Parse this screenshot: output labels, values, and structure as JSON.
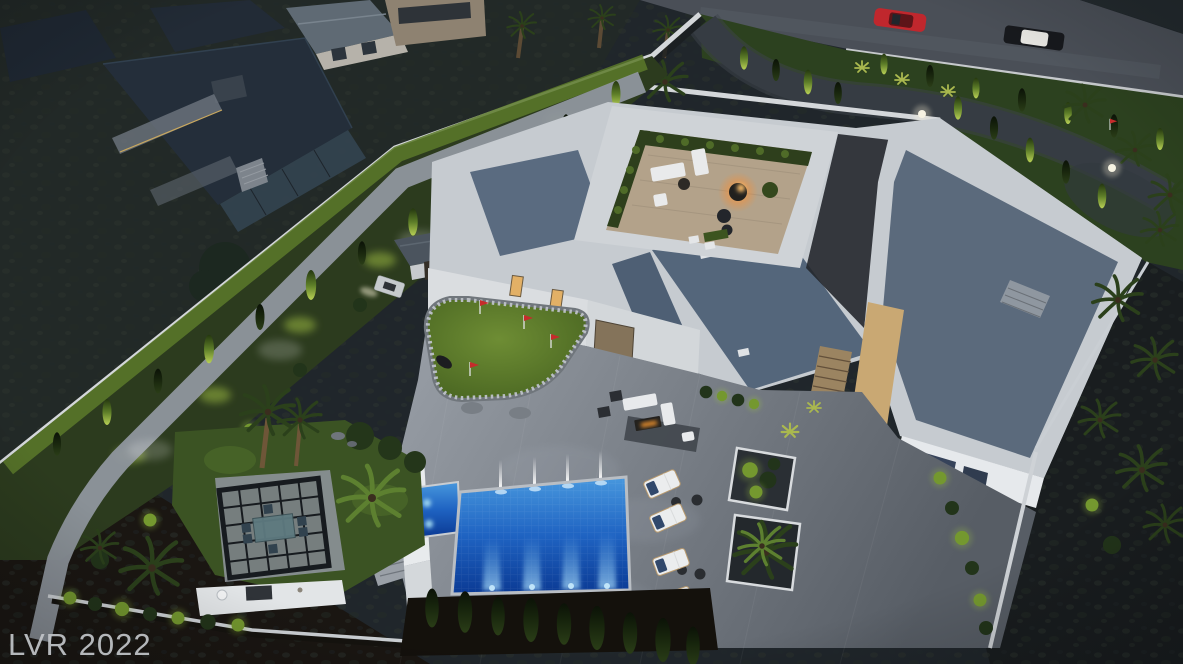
{
  "meta": {
    "description": "Aerial dusk 3D rendering of a walled luxury desert estate with modern white mansion, rooftop terrace, putting green, glowing swimming pool, pergola dining area and landscape lighting; neighboring dark modern home upper-left and a street with two cars upper-right.",
    "width": 1183,
    "height": 664
  },
  "watermark": {
    "text": "LVR 2022",
    "color": "#c2c5c9"
  },
  "scene": {
    "time_of_day": "dusk",
    "objects": [
      "neighboring-modern-house",
      "street-with-cars",
      "red-sports-car",
      "dark-car-white-roof",
      "front-lawn-with-curved-driveway",
      "perimeter-white-walls",
      "cypress-trees",
      "palm-trees",
      "modern-white-mansion",
      "slate-flat-roofs",
      "rooftop-terrace-lounge",
      "fire-bowl",
      "putting-green-with-red-flags",
      "golf-cart",
      "golf-cart-garage",
      "courtyard-fire-lounge",
      "swimming-pool",
      "spa",
      "fountain-jets",
      "underwater-pool-lights",
      "chaise-lounges",
      "pergola-dining-set",
      "outdoor-kitchen-counter",
      "landscape-uplighting",
      "glowing-orb-lights",
      "desert-hillside-scrub"
    ],
    "palette": {
      "desert_ground": "#20262b",
      "desert_soil": "#1a1612",
      "hillside": "#232b27",
      "road_asphalt": "#4a4f57",
      "curb": "#c6c9cc",
      "lawn": "#2c411f",
      "lawn_lit": "#7fa039",
      "cypress_dark": "#1d2d12",
      "cypress_lit": "#a6c243",
      "wall_white": "#c6cbd0",
      "wall_lit": "#eceef0",
      "roof_slate": "#54667b",
      "terrace_paver": "#b3a28a",
      "patio_light": "#9aa0a8",
      "patio_dark": "#575d65",
      "pool_shallow": "#4898de",
      "pool_deep": "#0b3a94",
      "pool_light_beam": "#9ed2f5",
      "putting_green": "#6e8d34",
      "window_warm": "#e2b066",
      "fire_glow": "#ffb054",
      "car_red": "#c0272d",
      "car_dark": "#17191d",
      "car_roof_white": "#e6e5e1"
    }
  }
}
